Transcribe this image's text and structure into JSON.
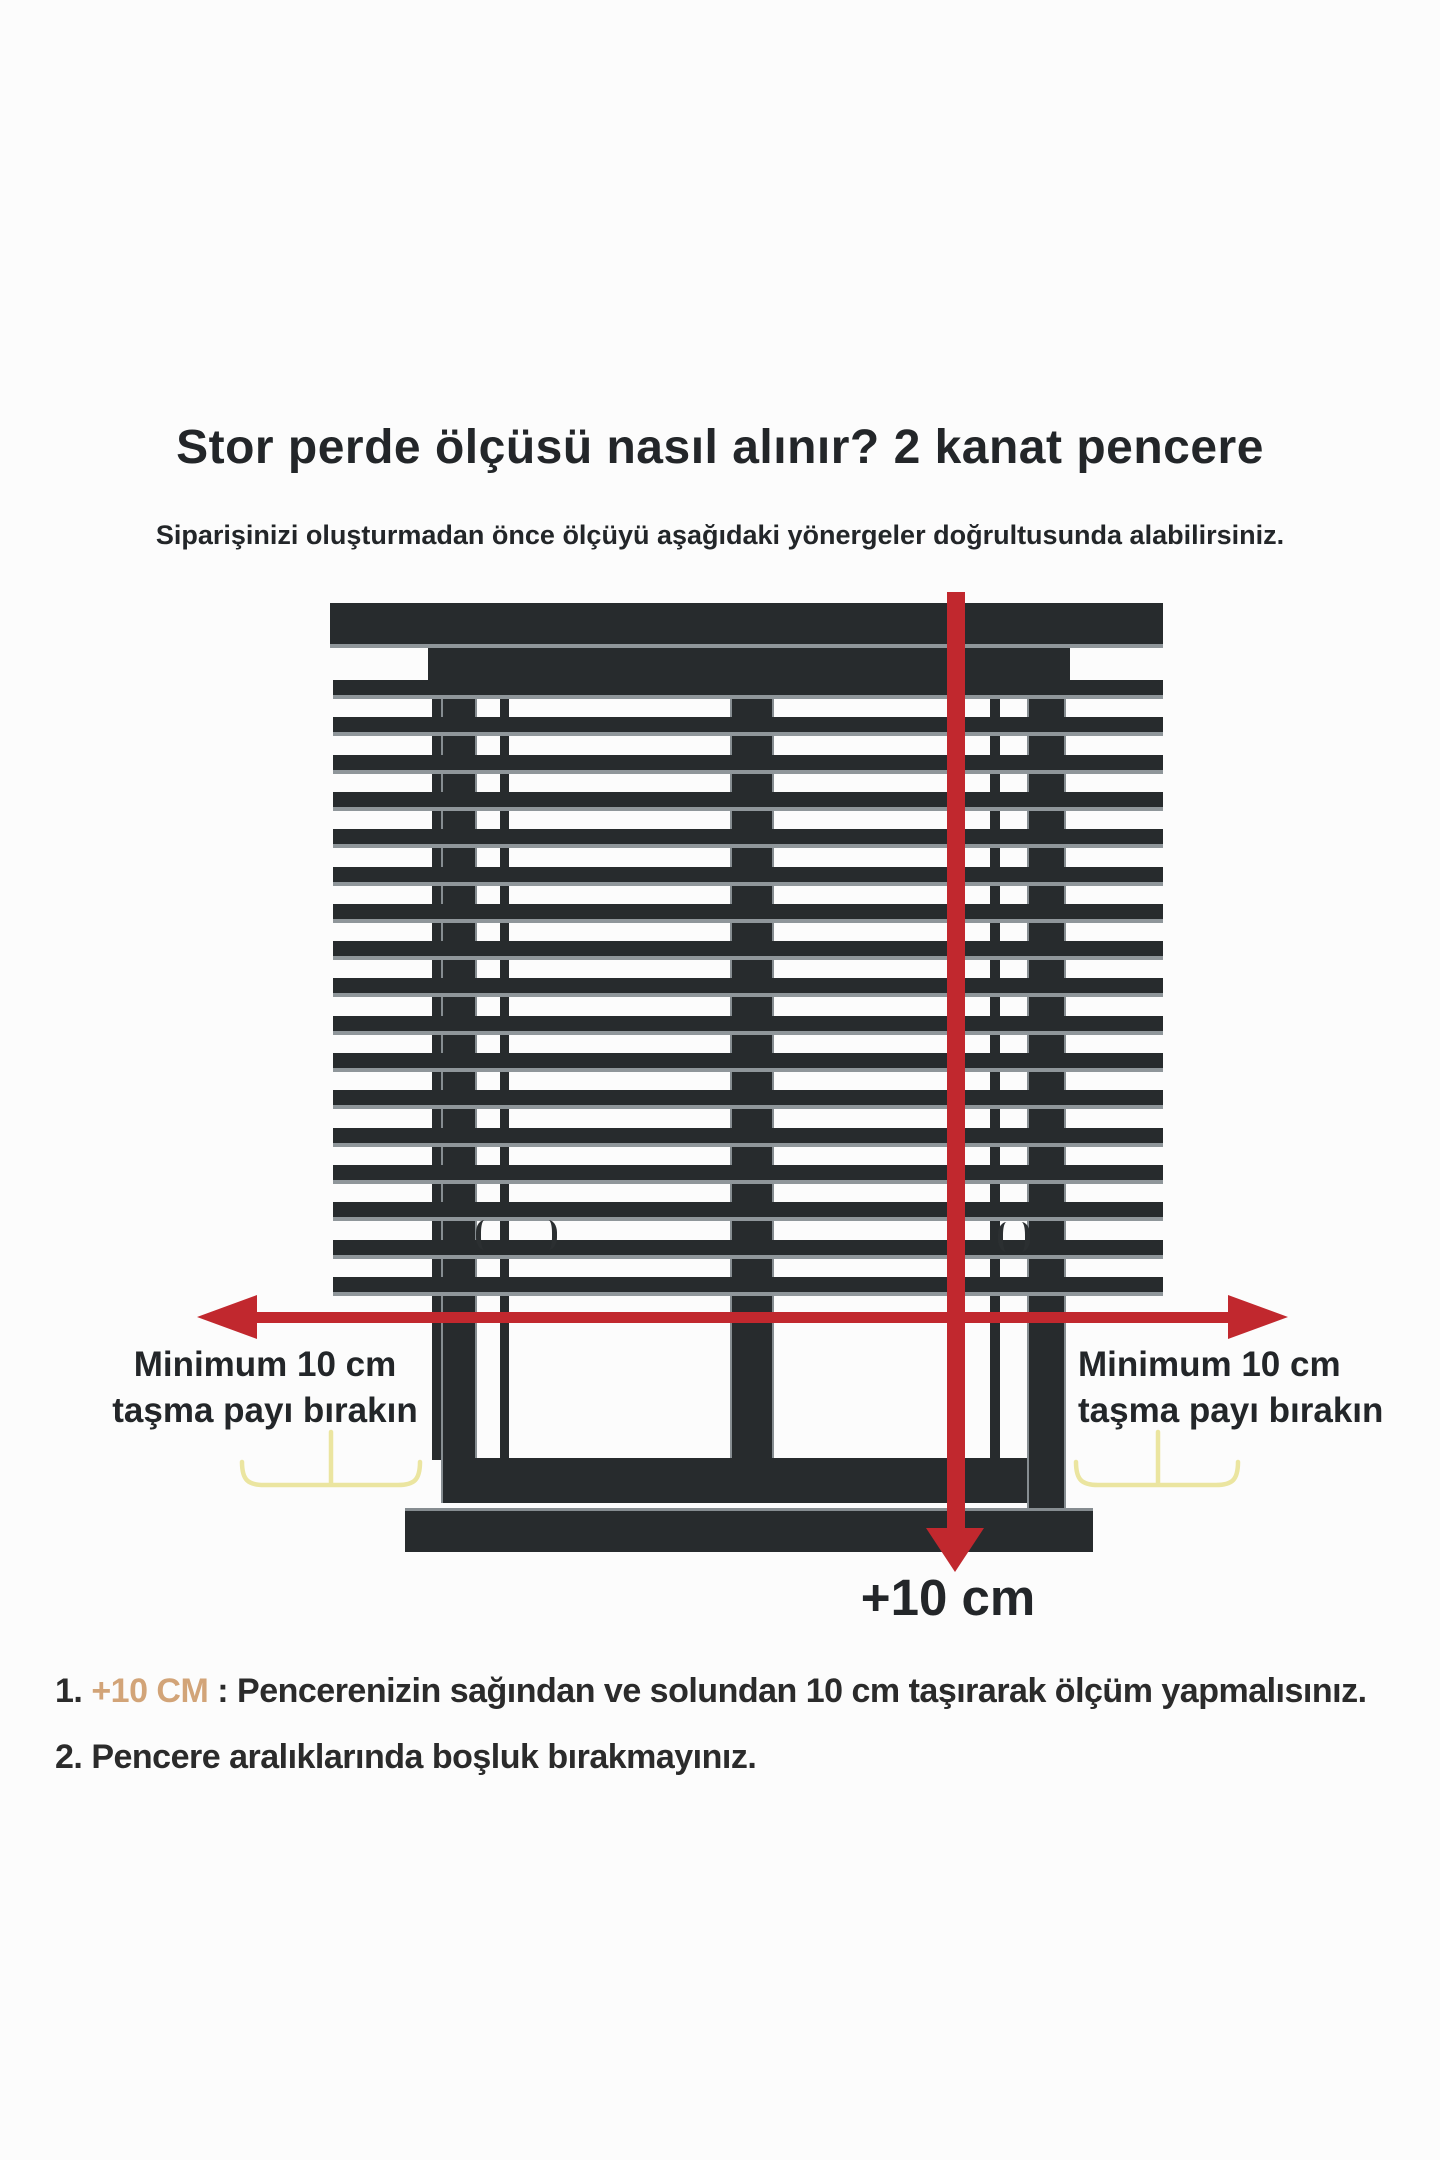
{
  "title": "Stor perde ölçüsü nasıl alınır? 2 kanat pencere",
  "subtitle": "Siparişinizi oluşturmadan önce ölçüyü aşağıdaki yönergeler doğrultusunda alabilirsiniz.",
  "diagram": {
    "left_label_line1": "Minimum 10 cm",
    "left_label_line2": "taşma payı bırakın",
    "right_label_line1": "Minimum 10 cm",
    "right_label_line2": "taşma payı bırakın",
    "bottom_arrow_label": "+10 cm",
    "slat_count": 17,
    "colors": {
      "frame_dark": "#272b2d",
      "slat_edge": "#8f969a",
      "arrow_red": "#c1282e",
      "brace_yellow": "#ebe5a0"
    }
  },
  "highlight_color": "#d2a478",
  "instructions": [
    {
      "number": "1. ",
      "highlight": "+10 CM",
      "separator": " : ",
      "text": "Pencerenizin sağından ve solundan 10 cm taşırarak ölçüm yapmalısınız."
    },
    {
      "number": "2. ",
      "highlight": "",
      "separator": "",
      "text": "Pencere aralıklarında boşluk bırakmayınız."
    }
  ]
}
